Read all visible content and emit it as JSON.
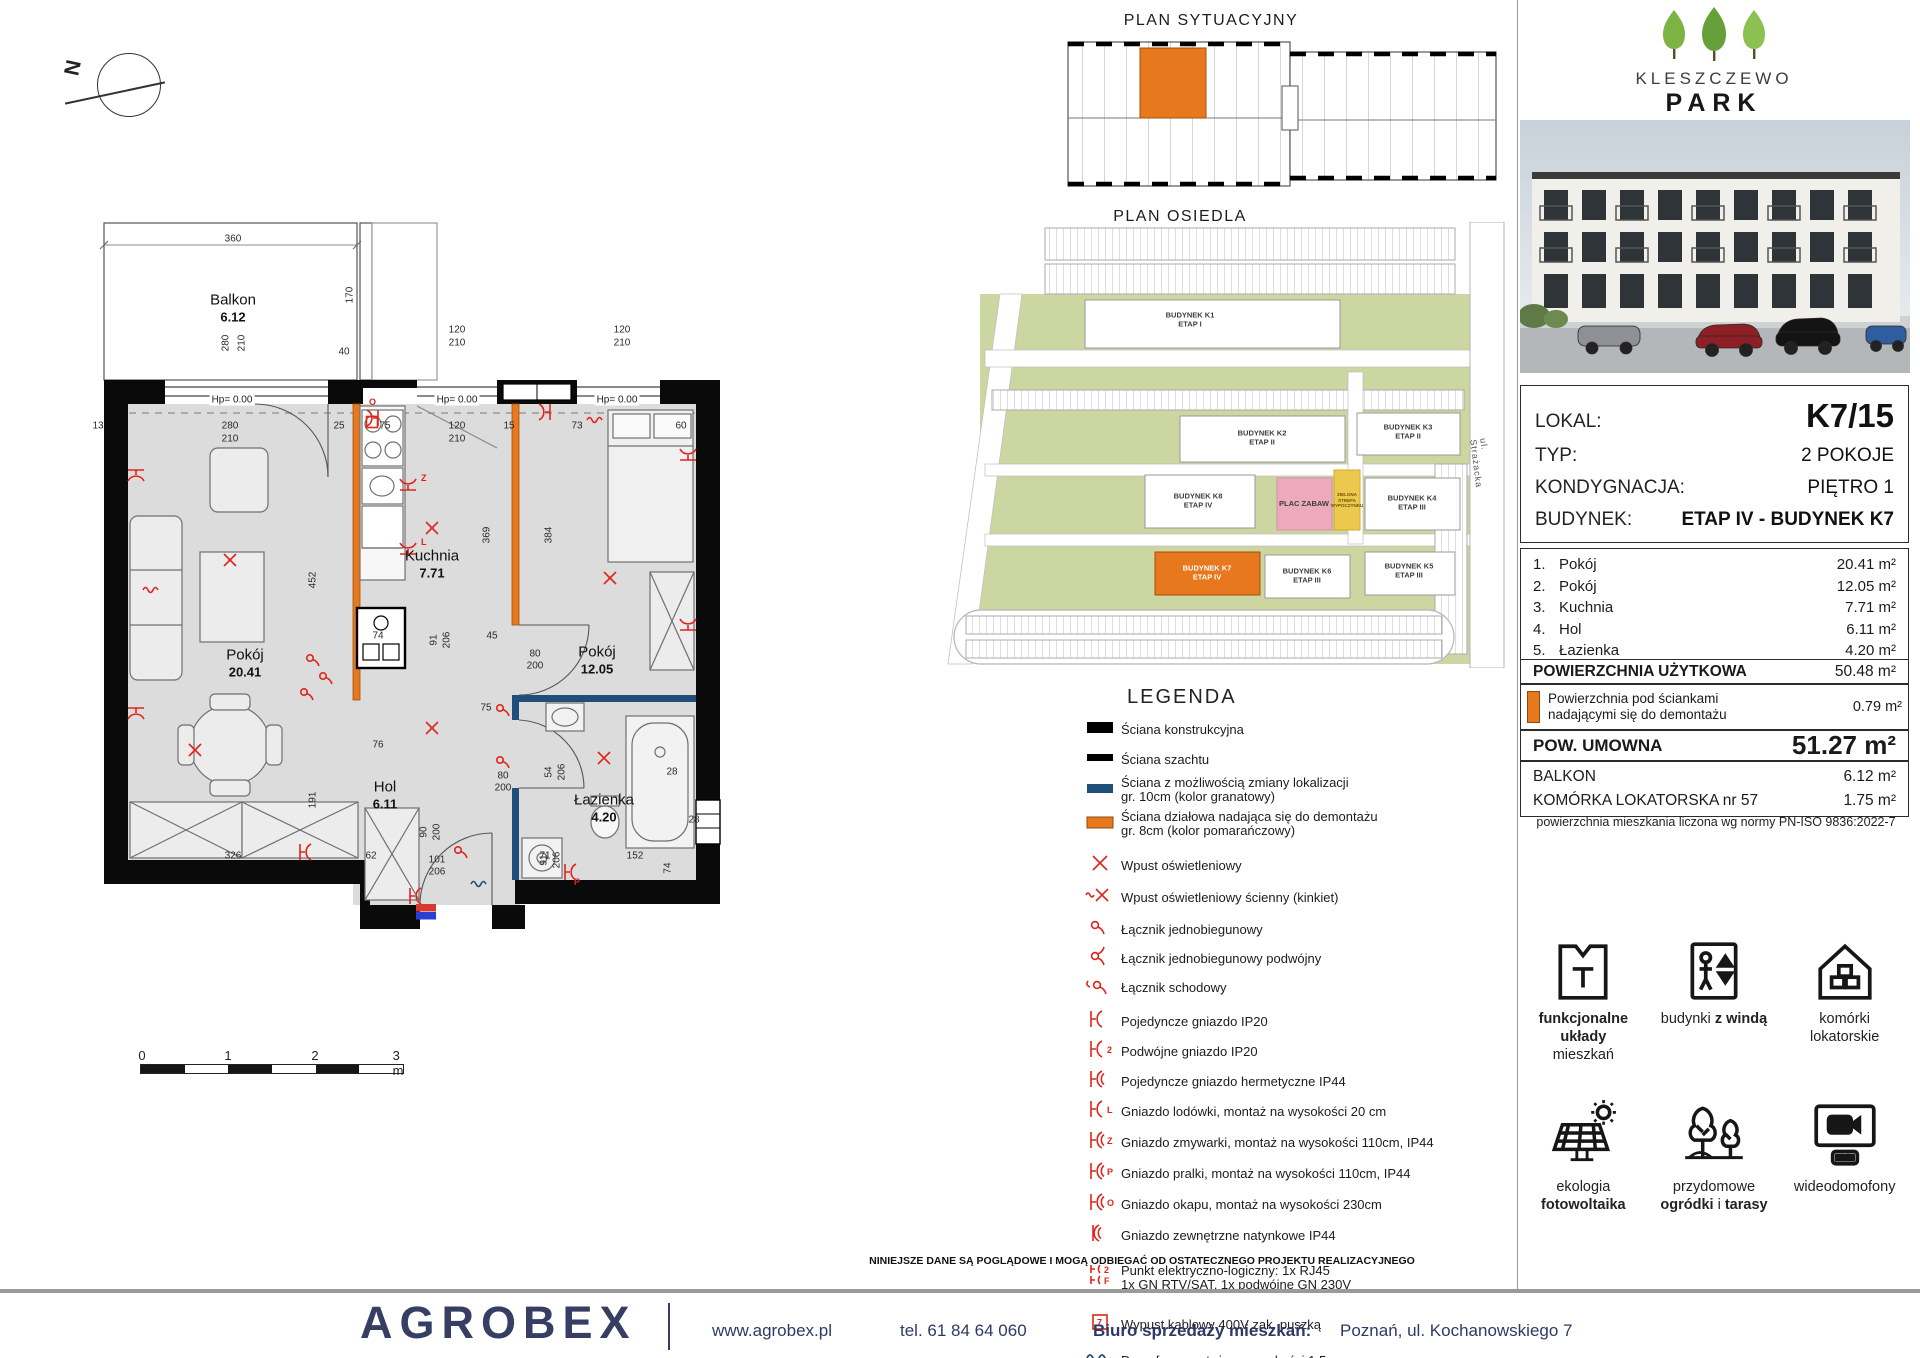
{
  "compass": {
    "label": "N"
  },
  "titles": {
    "sytuacyjny": "PLAN SYTUACYJNY",
    "osiedle": "PLAN OSIEDLA",
    "legend": "LEGENDA"
  },
  "logo": {
    "name": "KLESZCZEWO",
    "sub": "PARK"
  },
  "plan": {
    "balcony": {
      "name": "Balkon",
      "area": "6.12",
      "x": 173,
      "y": 140
    },
    "rooms": [
      {
        "name": "Pokój",
        "area": "20.41",
        "x": 185,
        "y": 495
      },
      {
        "name": "Kuchnia",
        "area": "7.71",
        "x": 372,
        "y": 396
      },
      {
        "name": "Pokój",
        "area": "12.05",
        "x": 537,
        "y": 492
      },
      {
        "name": "Hol",
        "area": "6.11",
        "x": 325,
        "y": 627
      },
      {
        "name": "Łazienka",
        "area": "4.20",
        "x": 544,
        "y": 640
      }
    ],
    "hp": [
      {
        "text": "Hp= 0.00",
        "x": 172,
        "y": 240
      },
      {
        "text": "Hp= 0.00",
        "x": 397,
        "y": 240
      },
      {
        "text": "Hp= 0.00",
        "x": 557,
        "y": 240
      }
    ],
    "dims": [
      {
        "t": "360",
        "x": 173,
        "y": 79
      },
      {
        "t": "280",
        "x": 166,
        "y": 183,
        "r": 1
      },
      {
        "t": "210",
        "x": 182,
        "y": 183,
        "r": 1
      },
      {
        "t": "170",
        "x": 290,
        "y": 135,
        "r": 1
      },
      {
        "t": "40",
        "x": 284,
        "y": 192
      },
      {
        "t": "120",
        "x": 397,
        "y": 170
      },
      {
        "t": "210",
        "x": 397,
        "y": 183
      },
      {
        "t": "120",
        "x": 562,
        "y": 170
      },
      {
        "t": "210",
        "x": 562,
        "y": 183
      },
      {
        "t": "13",
        "x": 38,
        "y": 266
      },
      {
        "t": "280",
        "x": 170,
        "y": 266
      },
      {
        "t": "210",
        "x": 170,
        "y": 279
      },
      {
        "t": "25",
        "x": 279,
        "y": 266
      },
      {
        "t": "75",
        "x": 325,
        "y": 266
      },
      {
        "t": "120",
        "x": 397,
        "y": 266
      },
      {
        "t": "210",
        "x": 397,
        "y": 279
      },
      {
        "t": "15",
        "x": 449,
        "y": 266
      },
      {
        "t": "73",
        "x": 517,
        "y": 266
      },
      {
        "t": "60",
        "x": 621,
        "y": 266
      },
      {
        "t": "452",
        "x": 253,
        "y": 420,
        "r": 1
      },
      {
        "t": "369",
        "x": 427,
        "y": 375,
        "r": 1
      },
      {
        "t": "384",
        "x": 489,
        "y": 375,
        "r": 1
      },
      {
        "t": "191",
        "x": 253,
        "y": 640,
        "r": 1
      },
      {
        "t": "91",
        "x": 374,
        "y": 480,
        "r": 1
      },
      {
        "t": "206",
        "x": 387,
        "y": 480,
        "r": 1
      },
      {
        "t": "74",
        "x": 318,
        "y": 476
      },
      {
        "t": "45",
        "x": 432,
        "y": 476
      },
      {
        "t": "80",
        "x": 475,
        "y": 494
      },
      {
        "t": "200",
        "x": 475,
        "y": 506
      },
      {
        "t": "75",
        "x": 426,
        "y": 548
      },
      {
        "t": "76",
        "x": 318,
        "y": 585
      },
      {
        "t": "54",
        "x": 489,
        "y": 612,
        "r": 1
      },
      {
        "t": "206",
        "x": 502,
        "y": 612,
        "r": 1
      },
      {
        "t": "80",
        "x": 443,
        "y": 616
      },
      {
        "t": "200",
        "x": 443,
        "y": 628
      },
      {
        "t": "28",
        "x": 612,
        "y": 612
      },
      {
        "t": "91",
        "x": 484,
        "y": 700,
        "r": 1
      },
      {
        "t": "206",
        "x": 497,
        "y": 700,
        "r": 1
      },
      {
        "t": "326",
        "x": 173,
        "y": 696
      },
      {
        "t": "62",
        "x": 311,
        "y": 696
      },
      {
        "t": "101",
        "x": 377,
        "y": 700
      },
      {
        "t": "206",
        "x": 377,
        "y": 712
      },
      {
        "t": "90",
        "x": 364,
        "y": 672,
        "r": 1
      },
      {
        "t": "200",
        "x": 377,
        "y": 672,
        "r": 1
      },
      {
        "t": "71",
        "x": 485,
        "y": 696
      },
      {
        "t": "152",
        "x": 575,
        "y": 696
      },
      {
        "t": "28",
        "x": 634,
        "y": 660
      },
      {
        "t": "74",
        "x": 608,
        "y": 708,
        "r": 1
      }
    ],
    "symbols": [
      {
        "k": "x",
        "x": 170,
        "y": 400
      },
      {
        "k": "x",
        "x": 135,
        "y": 590
      },
      {
        "k": "x",
        "x": 372,
        "y": 368
      },
      {
        "k": "x",
        "x": 550,
        "y": 418
      },
      {
        "k": "x",
        "x": 372,
        "y": 568
      },
      {
        "k": "x",
        "x": 544,
        "y": 598
      },
      {
        "k": "sock",
        "x": 76,
        "y": 310,
        "r": 90
      },
      {
        "k": "sock",
        "x": 76,
        "y": 548,
        "r": 90
      },
      {
        "k": "sock",
        "x": 240,
        "y": 692,
        "r": 0
      },
      {
        "k": "sock",
        "x": 490,
        "y": 252,
        "r": 180
      },
      {
        "k": "sock",
        "x": 628,
        "y": 300,
        "r": 270
      },
      {
        "k": "sock",
        "x": 628,
        "y": 470,
        "r": 270
      },
      {
        "k": "sock",
        "x": 350,
        "y": 736,
        "r": 0
      },
      {
        "k": "sock",
        "x": 348,
        "y": 330,
        "r": 270,
        "l": "Z"
      },
      {
        "k": "sock",
        "x": 348,
        "y": 394,
        "r": 270,
        "l": "L"
      },
      {
        "k": "sock",
        "x": 318,
        "y": 258,
        "r": 180,
        "l": "O"
      },
      {
        "k": "sock",
        "x": 505,
        "y": 712,
        "r": 0,
        "l": "P"
      },
      {
        "k": "sw",
        "x": 250,
        "y": 498
      },
      {
        "k": "sw",
        "x": 263,
        "y": 516
      },
      {
        "k": "sw",
        "x": 244,
        "y": 532
      },
      {
        "k": "sw",
        "x": 440,
        "y": 548
      },
      {
        "k": "sw",
        "x": 440,
        "y": 600
      },
      {
        "k": "sw",
        "x": 398,
        "y": 690
      },
      {
        "k": "wavy",
        "x": 92,
        "y": 430
      },
      {
        "k": "wavy",
        "x": 536,
        "y": 260
      },
      {
        "k": "sq",
        "x": 312,
        "y": 262
      },
      {
        "k": "board",
        "x": 366,
        "y": 752
      },
      {
        "k": "domo",
        "x": 420,
        "y": 724
      }
    ]
  },
  "map": {
    "street": "ul. Strażacka",
    "buildings": [
      {
        "l1": "BUDYNEK K1",
        "l2": "ETAP I",
        "x": 260,
        "y": 98
      },
      {
        "l1": "BUDYNEK K2",
        "l2": "ETAP II",
        "x": 332,
        "y": 216
      },
      {
        "l1": "BUDYNEK K3",
        "l2": "ETAP II",
        "x": 478,
        "y": 210
      },
      {
        "l1": "BUDYNEK K8",
        "l2": "ETAP IV",
        "x": 268,
        "y": 279
      },
      {
        "l1": "PLAC ZABAW",
        "l2": "",
        "x": 374,
        "y": 282
      },
      {
        "l1": "BUDYNEK K4",
        "l2": "ETAP III",
        "x": 482,
        "y": 281
      },
      {
        "l1": "BUDYNEK K7",
        "l2": "ETAP IV",
        "x": 277,
        "y": 351,
        "white": true
      },
      {
        "l1": "BUDYNEK K6",
        "l2": "ETAP III",
        "x": 377,
        "y": 354
      },
      {
        "l1": "BUDYNEK K5",
        "l2": "ETAP III",
        "x": 479,
        "y": 349
      }
    ],
    "green_zone": [
      "ZIELONA",
      "STREFA",
      "WYPOCZYNKU"
    ],
    "street_xy": {
      "x": 552,
      "y": 248
    }
  },
  "legend": {
    "items": [
      {
        "ic": "wallA",
        "lines": [
          "Ściana konstrukcyjna"
        ],
        "mt": 8
      },
      {
        "ic": "wallB",
        "lines": [
          "Ściana szachtu"
        ],
        "mt": 5
      },
      {
        "ic": "wallN",
        "lines": [
          "Ściana z możliwością zmiany lokalizacji",
          "gr. 10cm (kolor granatowy)"
        ],
        "mt": 4
      },
      {
        "ic": "wallO",
        "lines": [
          "Ściana działowa nadająca się do demontażu",
          "gr. 8cm (kolor pomarańczowy)"
        ],
        "mt": 6
      },
      {
        "ic": "x",
        "lines": [
          "Wpust oświetleniowy"
        ],
        "mt": 15
      },
      {
        "ic": "xwall",
        "lines": [
          "Wpust oświetleniowy ścienny (kinkiet)"
        ],
        "mt": 7
      },
      {
        "ic": "sw1",
        "lines": [
          "Łącznik jednobiegunowy"
        ],
        "mt": 7
      },
      {
        "ic": "sw2",
        "lines": [
          "Łącznik jednobiegunowy podwójny"
        ],
        "mt": 4
      },
      {
        "ic": "sw3",
        "lines": [
          "Łącznik schodowy"
        ],
        "mt": 4
      },
      {
        "ic": "sock",
        "letter": "",
        "lines": [
          "Pojedyncze gniazdo IP20"
        ],
        "mt": 9
      },
      {
        "ic": "sock",
        "letter": "2",
        "lines": [
          "Podwójne gniazdo IP20"
        ],
        "mt": 5
      },
      {
        "ic": "sockH",
        "letter": "",
        "lines": [
          "Pojedyncze gniazdo hermetyczne IP44"
        ],
        "mt": 5
      },
      {
        "ic": "sock",
        "letter": "L",
        "lines": [
          "Gniazdo lodówki, montaż na wysokości 20 cm"
        ],
        "mt": 5
      },
      {
        "ic": "sockH",
        "letter": "Z",
        "lines": [
          "Gniazdo zmywarki, montaż na wysokości 110cm,  IP44"
        ],
        "mt": 6
      },
      {
        "ic": "sockH",
        "letter": "P",
        "lines": [
          "Gniazdo pralki, montaż na wysokości 110cm, IP44"
        ],
        "mt": 6
      },
      {
        "ic": "sockH",
        "letter": "O",
        "lines": [
          "Gniazdo okapu, montaż na wysokości 230cm"
        ],
        "mt": 6
      },
      {
        "ic": "sockK",
        "letter": "",
        "lines": [
          "Gniazdo zewnętrzne natynkowe IP44"
        ],
        "mt": 6
      },
      {
        "ic": "elog",
        "lines": [
          "Punkt elektryczno-logiczny: 1x RJ45",
          "1x GN RTV/SAT, 1x podwójne GN 230V"
        ],
        "mt": 16
      },
      {
        "ic": "sq",
        "lines": [
          "Wypust kablowy 400V zak. puszką"
        ],
        "mt": 20
      },
      {
        "ic": "domo",
        "lines": [
          "Domofon, montaż na wysokości 1,5m"
        ],
        "mt": 11
      },
      {
        "ic": "board",
        "lines": [
          "Tablica mieszkaniowa"
        ],
        "mt": 10
      }
    ]
  },
  "details": {
    "rows": [
      {
        "label": "LOKAL:",
        "value": "K7/15",
        "style": "big"
      },
      {
        "label": "TYP:",
        "value": "2 POKOJE",
        "style": ""
      },
      {
        "label": "KONDYGNACJA:",
        "value": "PIĘTRO 1",
        "style": ""
      },
      {
        "label": "BUDYNEK:",
        "value": "ETAP IV - BUDYNEK  K7",
        "style": "bold"
      }
    ]
  },
  "room_table": {
    "rows": [
      {
        "num": "1.",
        "name": "Pokój",
        "area": "20.41 m²"
      },
      {
        "num": "2.",
        "name": "Pokój",
        "area": "12.05 m²"
      },
      {
        "num": "3.",
        "name": "Kuchnia",
        "area": "7.71 m²"
      },
      {
        "num": "4.",
        "name": "Hol",
        "area": "6.11 m²"
      },
      {
        "num": "5.",
        "name": "Łazienka",
        "area": "4.20 m²"
      }
    ]
  },
  "summary": {
    "usable_label": "POWIERZCHNIA UŻYTKOWA",
    "usable_value": "50.48 m²",
    "demont_line1": "Powierzchnia pod ściankami",
    "demont_line2": "nadającymi się do demontażu",
    "demont_value": "0.79 m²",
    "umowna_label": "POW. UMOWNA",
    "umowna_value": "51.27 m²",
    "balkon_label": "BALKON",
    "balkon_value": "6.12 m²",
    "komorka_label": "KOMÓRKA LOKATORSKA nr 57",
    "komorka_value": "1.75 m²",
    "note": "powierzchnia mieszkania liczona wg normy PN-ISO 9836:2022-7"
  },
  "features": [
    {
      "icon": "layout-icon",
      "lines": [
        [
          [
            "funkcjonalne układy",
            1
          ]
        ],
        [
          [
            "mieszkań",
            0
          ]
        ]
      ]
    },
    {
      "icon": "elevator-icon",
      "lines": [
        [
          [
            "budynki ",
            0
          ],
          [
            "z windą",
            1
          ]
        ]
      ]
    },
    {
      "icon": "storage-icon",
      "lines": [
        [
          [
            "komórki",
            0
          ]
        ],
        [
          [
            "lokatorskie",
            0
          ]
        ]
      ]
    },
    {
      "icon": "solar-icon",
      "lines": [
        [
          [
            "ekologia",
            0
          ]
        ],
        [
          [
            "fotowoltaika",
            1
          ]
        ]
      ]
    },
    {
      "icon": "garden-icon",
      "lines": [
        [
          [
            "przydomowe",
            0
          ]
        ],
        [
          [
            "ogródki",
            1
          ],
          [
            " i ",
            0
          ],
          [
            "tarasy",
            1
          ]
        ]
      ]
    },
    {
      "icon": "videophone-icon",
      "lines": [
        [
          [
            "wideodomofony",
            0
          ]
        ]
      ]
    }
  ],
  "scalebar": {
    "labels": [
      "0",
      "1",
      "2",
      "3 m"
    ]
  },
  "footer": {
    "disclaimer": "NINIEJSZE DANE SĄ POGLĄDOWE I MOGĄ ODBIEGAĆ OD OSTATECZNEGO PROJEKTU REALIZACYJNEGO",
    "brand": "AGROBEX",
    "website": "www.agrobex.pl",
    "phone": "tel. 61 84 64 060",
    "office_label": "Biuro sprzedaży mieszkań:",
    "office_value": "Poznań, ul. Kochanowskiego 7"
  },
  "colors": {
    "orange": "#e8781e",
    "navy": "#1f4e79",
    "red": "#e0241b",
    "brand_navy": "#373e63"
  }
}
